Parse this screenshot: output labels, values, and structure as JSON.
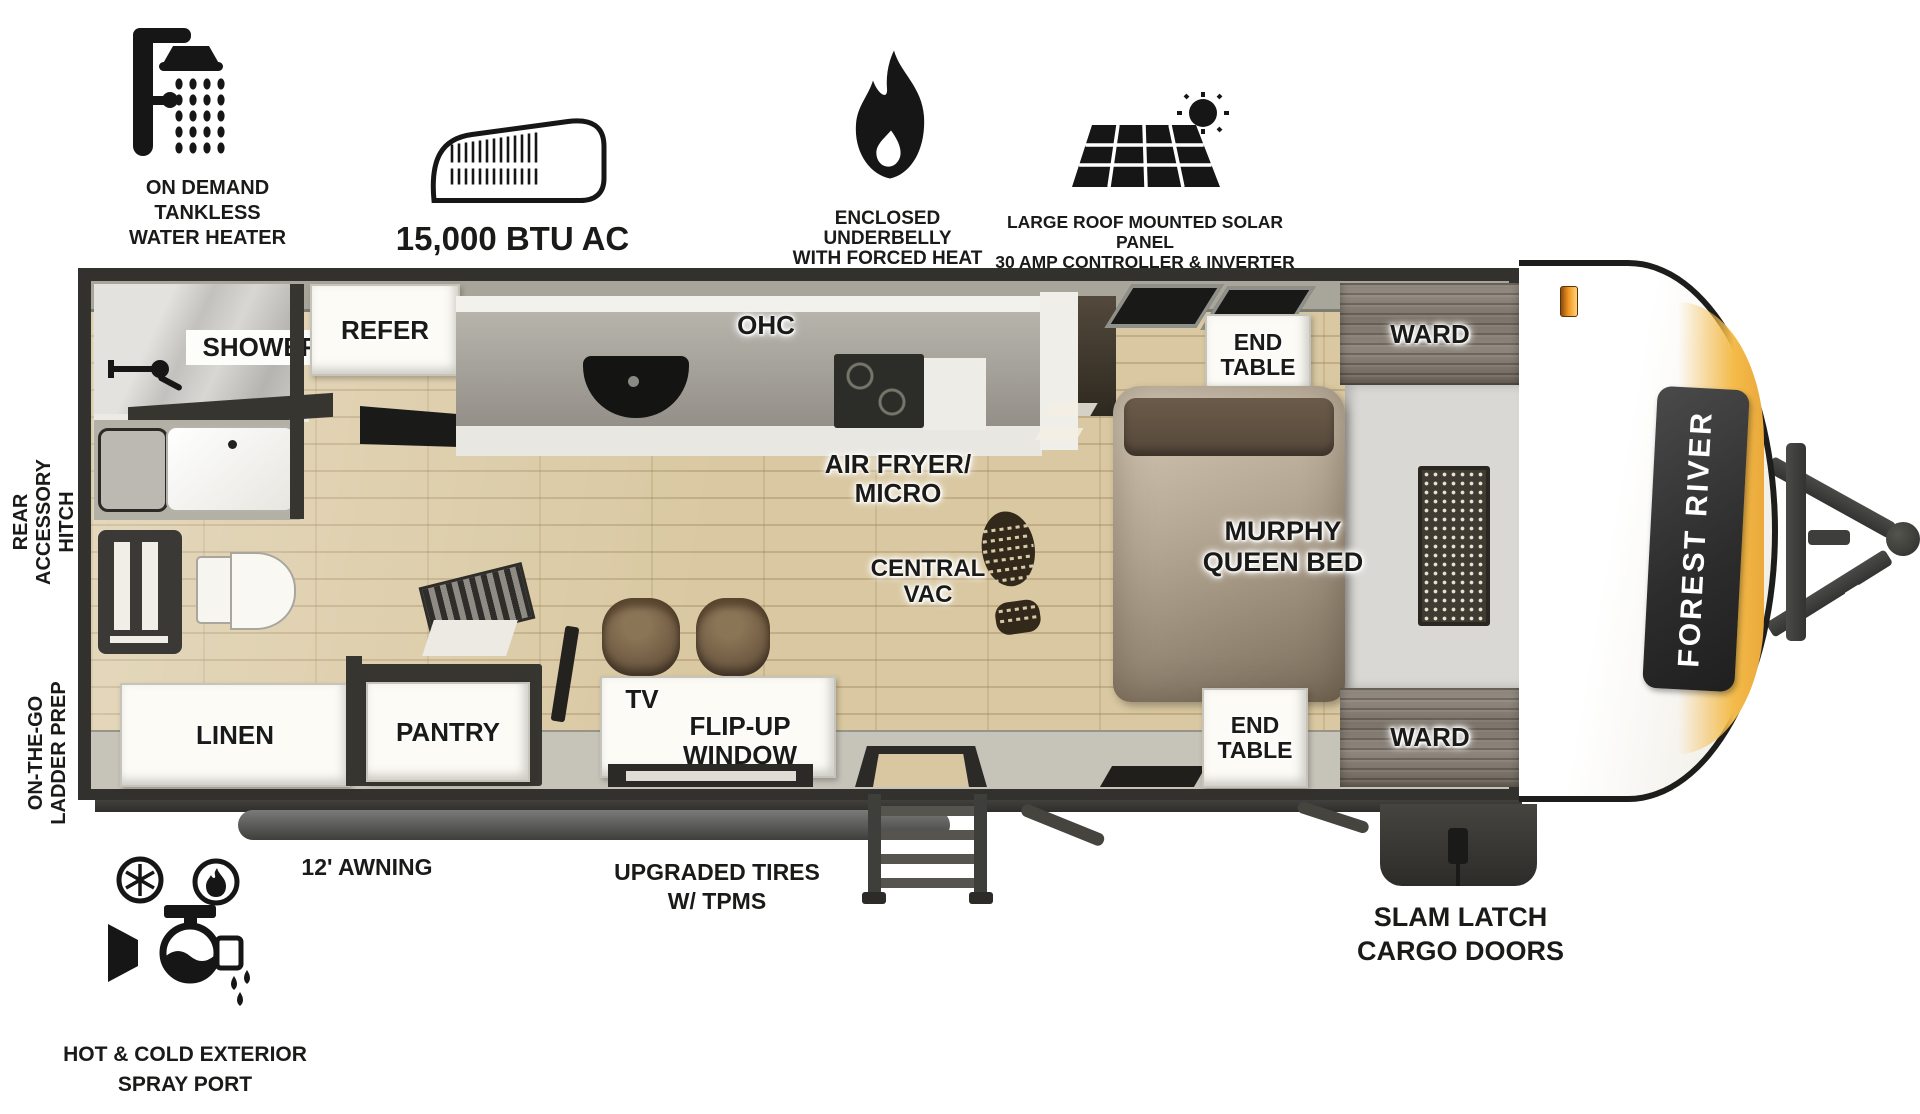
{
  "colors": {
    "accent_yellow": "#f4bb4a",
    "marker_orange": "#f0931f",
    "badge_dark": "#2c2c2c",
    "plan_border": "#32312d",
    "wood_floor": "#d9c8a1"
  },
  "top_features": [
    {
      "icon": "shower-icon",
      "label": "ON DEMAND\nTANKLESS\nWATER HEATER"
    },
    {
      "icon": "ac-unit-icon",
      "label": "15,000 BTU AC"
    },
    {
      "icon": "flame-icon",
      "label": "ENCLOSED UNDERBELLY\nWITH FORCED HEAT"
    },
    {
      "icon": "solar-panel-icon",
      "label": "LARGE ROOF MOUNTED SOLAR PANEL\n30 AMP CONTROLLER & INVERTER PREP"
    }
  ],
  "side_features": {
    "rear_hitch": "REAR\nACCESSORY\nHITCH",
    "ladder_prep": "ON-THE-GO\nLADDER PREP"
  },
  "bottom_features": {
    "spray_port": {
      "icon": "spray-port-icon",
      "label": "HOT & COLD EXTERIOR\nSPRAY PORT"
    },
    "awning": "12' AWNING",
    "tires": "UPGRADED TIRES\nW/ TPMS",
    "cargo_doors": "SLAM LATCH\nCARGO DOORS"
  },
  "floorplan": {
    "bathroom": {
      "shower": "SHOWER",
      "linen": "LINEN"
    },
    "kitchen": {
      "refer": "REFER",
      "ohc": "OHC",
      "air_fryer_micro": "AIR FRYER/\nMICRO",
      "central_vac": "CENTRAL\nVAC",
      "pantry": "PANTRY"
    },
    "living": {
      "tv": "TV",
      "flip_up_window": "FLIP-UP\nWINDOW"
    },
    "bedroom": {
      "end_table_top": "END\nTABLE",
      "end_table_bottom": "END\nTABLE",
      "ward_top": "WARD",
      "ward_bottom": "WARD",
      "murphy_bed": "MURPHY\nQUEEN BED"
    }
  },
  "brand": {
    "name": "FOREST RIVER"
  }
}
